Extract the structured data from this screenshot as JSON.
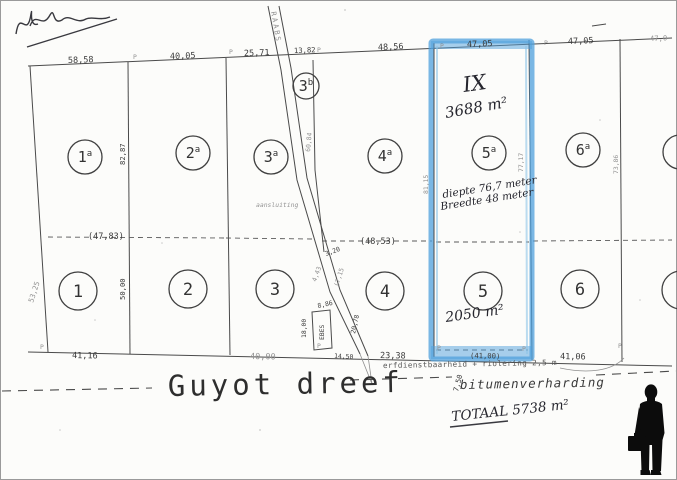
{
  "plan": {
    "street": {
      "name": "Guyot dreef",
      "surface_note": "bitumenverharding",
      "easement_note": "erfdienstbaarheid + riolering 2,5 m",
      "road_width": "7,50"
    },
    "total_note": "TOTAAL 5738 m²",
    "highlight": {
      "color": "#4fa0dc",
      "mark": "IX",
      "area_upper": "3688 m²",
      "area_lower": "2050 m²",
      "depth_note": "diepte 76,7 meter",
      "width_note": "Breedte 48 meter"
    },
    "marker_glyph": "P",
    "parcels_upper": [
      {
        "label": "1a",
        "x": 85,
        "y": 157,
        "r": 17
      },
      {
        "label": "2a",
        "x": 193,
        "y": 153,
        "r": 17
      },
      {
        "label": "3a",
        "x": 271,
        "y": 157,
        "r": 17
      },
      {
        "label": "3b",
        "x": 306,
        "y": 86,
        "r": 13
      },
      {
        "label": "4a",
        "x": 385,
        "y": 156,
        "r": 17
      },
      {
        "label": "5a",
        "x": 489,
        "y": 153,
        "r": 17
      },
      {
        "label": "6a",
        "x": 583,
        "y": 150,
        "r": 17
      }
    ],
    "parcels_lower": [
      {
        "label": "1",
        "x": 78,
        "y": 291,
        "r": 19
      },
      {
        "label": "2",
        "x": 188,
        "y": 289,
        "r": 19
      },
      {
        "label": "3",
        "x": 275,
        "y": 289,
        "r": 19
      },
      {
        "label": "4",
        "x": 385,
        "y": 291,
        "r": 19
      },
      {
        "label": "5",
        "x": 483,
        "y": 291,
        "r": 19
      },
      {
        "label": "6",
        "x": 580,
        "y": 289,
        "r": 19
      }
    ],
    "edge_parcels": [
      {
        "x": 680,
        "y": 152,
        "r": 17
      },
      {
        "x": 681,
        "y": 290,
        "r": 19
      }
    ],
    "measurements": [
      {
        "t": "58,58",
        "x": 68,
        "y": 63,
        "r": -2
      },
      {
        "t": "40,05",
        "x": 170,
        "y": 59,
        "r": -2
      },
      {
        "t": "25,71",
        "x": 244,
        "y": 56,
        "r": -2
      },
      {
        "t": "13,82",
        "x": 294,
        "y": 53,
        "r": -2,
        "c": "sm"
      },
      {
        "t": "48,56",
        "x": 378,
        "y": 50,
        "r": -2
      },
      {
        "t": "47,05",
        "x": 467,
        "y": 47,
        "r": -2
      },
      {
        "t": "47,05",
        "x": 568,
        "y": 44,
        "r": -2
      },
      {
        "t": "47,0",
        "x": 650,
        "y": 41,
        "r": -2,
        "c": "sm faint"
      },
      {
        "t": "41,16",
        "x": 72,
        "y": 358,
        "r": 1
      },
      {
        "t": "40,00",
        "x": 250,
        "y": 359,
        "r": 1,
        "c": "faint"
      },
      {
        "t": "14,50",
        "x": 334,
        "y": 358,
        "r": 3,
        "c": "xs"
      },
      {
        "t": "23,38",
        "x": 380,
        "y": 358,
        "r": 1
      },
      {
        "t": "(41,00)",
        "x": 470,
        "y": 358,
        "r": 1,
        "c": "sm"
      },
      {
        "t": "41,06",
        "x": 560,
        "y": 359,
        "r": 1
      },
      {
        "t": "(47,83)",
        "x": 88,
        "y": 239
      },
      {
        "t": "(48,53)",
        "x": 360,
        "y": 244
      },
      {
        "t": "82,87",
        "x": 125,
        "y": 165,
        "r": -90,
        "c": "sm"
      },
      {
        "t": "50,00",
        "x": 125,
        "y": 300,
        "r": -90,
        "c": "sm"
      },
      {
        "t": "53,25",
        "x": 33,
        "y": 303,
        "r": -72,
        "c": "sm faint"
      },
      {
        "t": "60,84",
        "x": 310,
        "y": 152,
        "r": -85,
        "c": "xs faint"
      },
      {
        "t": "3,20",
        "x": 326,
        "y": 256,
        "r": -20,
        "c": "xs"
      },
      {
        "t": "4,43",
        "x": 316,
        "y": 282,
        "r": -70,
        "c": "xs faint"
      },
      {
        "t": "(7,15",
        "x": 338,
        "y": 287,
        "r": -72,
        "c": "xs faint"
      },
      {
        "t": "8,86",
        "x": 318,
        "y": 308,
        "r": -12,
        "c": "xs"
      },
      {
        "t": "18,00",
        "x": 306,
        "y": 338,
        "r": -90,
        "c": "xs"
      },
      {
        "t": "EBES",
        "x": 324,
        "y": 340,
        "r": -90,
        "c": "xs"
      },
      {
        "t": "20,78",
        "x": 355,
        "y": 334,
        "r": -78,
        "c": "xs"
      },
      {
        "t": "81,15",
        "x": 428,
        "y": 194,
        "r": -90,
        "c": "xs faint"
      },
      {
        "t": "77,17",
        "x": 523,
        "y": 172,
        "r": -90,
        "c": "xs faint"
      },
      {
        "t": "73,86",
        "x": 618,
        "y": 174,
        "r": -90,
        "c": "xs faint"
      },
      {
        "t": "7,50",
        "x": 458,
        "y": 392,
        "r": -75,
        "c": "sm"
      },
      {
        "t": "RAABS",
        "x": 271,
        "y": 12,
        "r": 80,
        "c": "sm sp faint"
      },
      {
        "t": "aansluiting",
        "x": 256,
        "y": 207,
        "c": "xs faint it"
      }
    ],
    "p_markers_top": [
      [
        133,
        59
      ],
      [
        229,
        54
      ],
      [
        317,
        52
      ],
      [
        440,
        48
      ],
      [
        544,
        45
      ]
    ],
    "p_markers_bottom": [
      [
        40,
        349
      ],
      [
        317,
        348
      ],
      [
        437,
        350
      ],
      [
        522,
        351
      ],
      [
        618,
        348
      ]
    ]
  }
}
